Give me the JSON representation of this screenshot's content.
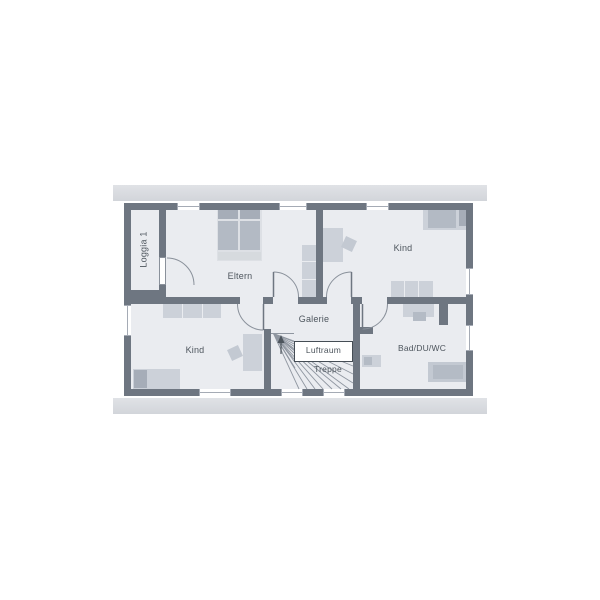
{
  "floor_plan": {
    "rooms": {
      "loggia": "Loggia 1",
      "eltern": "Eltern",
      "kind_top": "Kind",
      "kind_bottom": "Kind",
      "galerie": "Galerie",
      "luftraum": "Luftraum",
      "treppe": "Treppe",
      "bad": "Bad/DU/WC"
    },
    "colors": {
      "wall": "#6e7681",
      "floor": "#eaecf0",
      "roof_band": "#d7d9de",
      "furniture_light": "#ccd1d9",
      "furniture_dark": "#b4bbc5",
      "label_text": "#4d555d",
      "void_border": "#454d55"
    }
  }
}
